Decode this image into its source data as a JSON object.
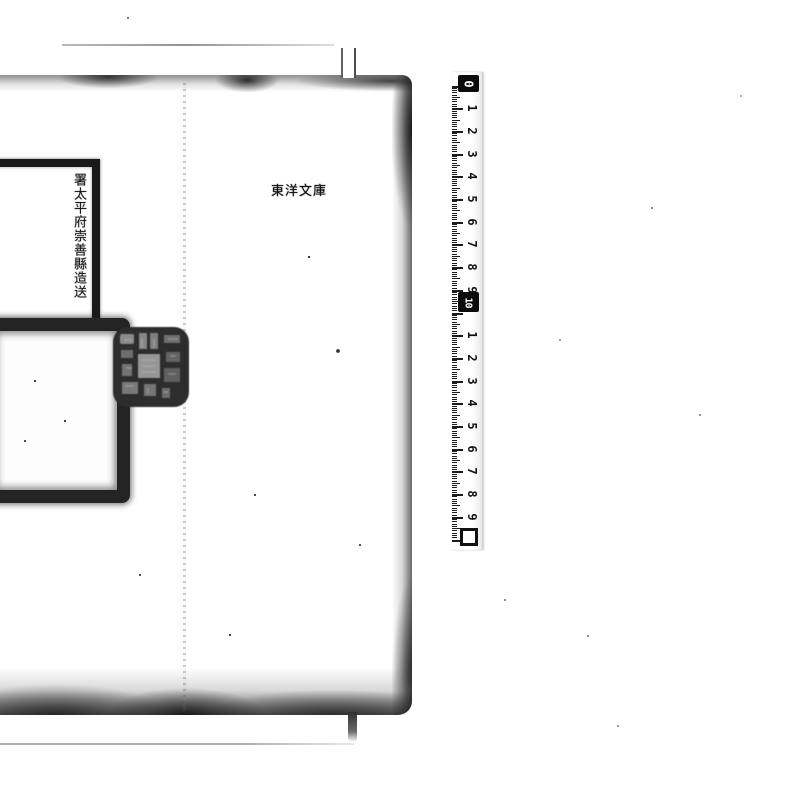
{
  "page": {
    "library_stamp": "東洋文庫",
    "submission_label": "署太平府崇善縣造送",
    "seal_icon": "square-seal-impression",
    "large_stamp_icon": "large-square-stamp-frame"
  },
  "ruler": {
    "marker_start": "0",
    "marker_mid": "10",
    "segment1": [
      "1",
      "2",
      "3",
      "4",
      "5",
      "6",
      "7",
      "8",
      "9"
    ],
    "segment2": [
      "1",
      "2",
      "3",
      "4",
      "5",
      "6",
      "7",
      "8",
      "9"
    ],
    "end_marker_icon": "open-square"
  },
  "colors": {
    "paper": "#ffffff",
    "ink": "#1b1b1b",
    "smudge": "#3f3f3f",
    "edge_line": "#9a9a9a"
  }
}
